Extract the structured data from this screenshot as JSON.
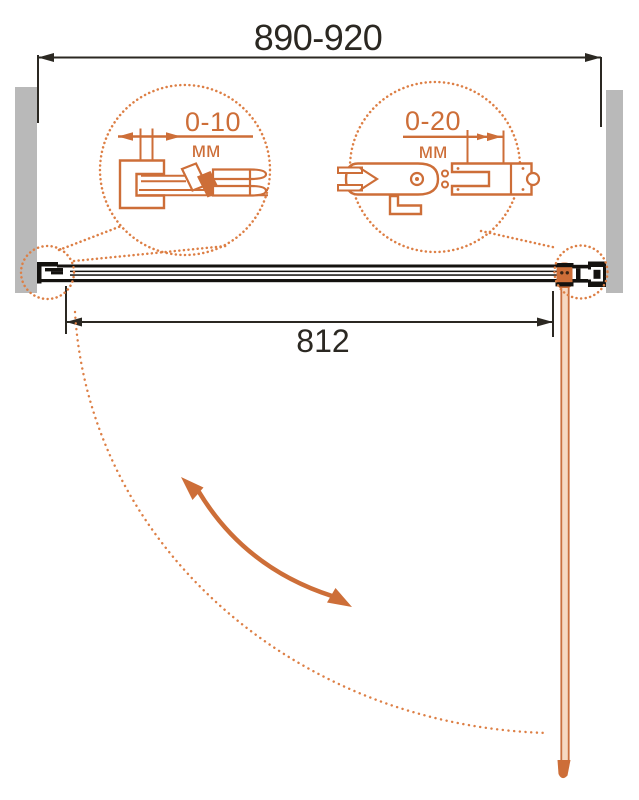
{
  "diagram": {
    "title": "shower-door-installation-plan-view",
    "dimensions": {
      "overall_width_range": "890-920",
      "door_glass_width": "812",
      "left_detail": {
        "range": "0-10",
        "unit": "мм"
      },
      "right_detail": {
        "range": "0-20",
        "unit": "мм"
      }
    },
    "colors": {
      "accent_orange": "#cd6e38",
      "dot_orange": "#dd7f45",
      "line_black": "#2b2822",
      "profile_black": "#14120f",
      "wall_gray": "#b9b9b9",
      "door_fill": "#f6d8c2"
    }
  }
}
